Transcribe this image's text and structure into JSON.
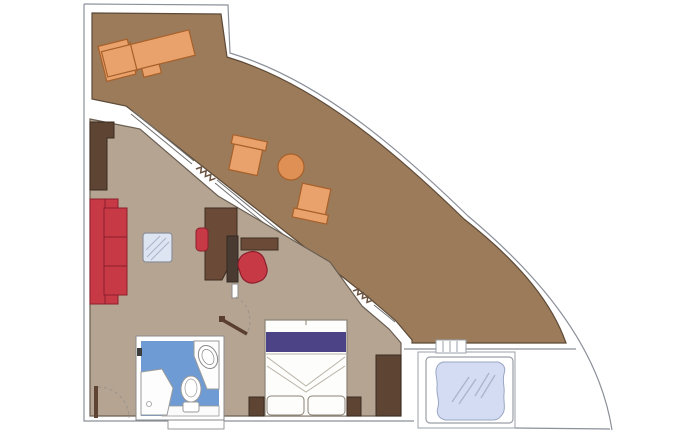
{
  "diagram": {
    "type": "floorplan",
    "subject": "cruise-ship-suite-with-wraparound-balcony-and-whirlpool",
    "rooms": [
      {
        "name": "balcony-terrace"
      },
      {
        "name": "living-room"
      },
      {
        "name": "bedroom"
      },
      {
        "name": "bathroom"
      },
      {
        "name": "whirlpool-deck"
      }
    ],
    "furniture": [
      {
        "name": "sun-lounger",
        "room": "balcony-terrace"
      },
      {
        "name": "deck-chair-1",
        "room": "balcony-terrace"
      },
      {
        "name": "deck-chair-2",
        "room": "balcony-terrace"
      },
      {
        "name": "round-table",
        "room": "balcony-terrace"
      },
      {
        "name": "sofa",
        "room": "living-room"
      },
      {
        "name": "glass-coffee-table",
        "room": "living-room"
      },
      {
        "name": "desk",
        "room": "living-room"
      },
      {
        "name": "desk-chair",
        "room": "living-room"
      },
      {
        "name": "tv-cabinet",
        "room": "living-room"
      },
      {
        "name": "console-shelf",
        "room": "living-room"
      },
      {
        "name": "tub-chair",
        "room": "living-room"
      },
      {
        "name": "entry-wardrobe",
        "room": "living-room"
      },
      {
        "name": "double-bed",
        "room": "bedroom"
      },
      {
        "name": "nightstand-left",
        "room": "bedroom"
      },
      {
        "name": "nightstand-right",
        "room": "bedroom"
      },
      {
        "name": "wardrobe",
        "room": "bedroom"
      },
      {
        "name": "shower",
        "room": "bathroom"
      },
      {
        "name": "toilet",
        "room": "bathroom"
      },
      {
        "name": "washbasin",
        "room": "bathroom"
      },
      {
        "name": "whirlpool-tub",
        "room": "whirlpool-deck"
      },
      {
        "name": "steps",
        "room": "whirlpool-deck"
      }
    ],
    "symbols": [
      {
        "name": "entry-door-swing"
      },
      {
        "name": "bedroom-door-swing"
      },
      {
        "name": "curtain-squiggle-living"
      },
      {
        "name": "curtain-squiggle-bedroom"
      },
      {
        "name": "hull-curve"
      }
    ]
  },
  "palette": {
    "bg": "#ffffff",
    "balcony-floor": "#9b7b5a",
    "balcony-stroke": "#5d4a38",
    "interior-floor": "#b5a492",
    "interior-stroke": "#6a5f52",
    "wood-dark": "#5d4433",
    "wood-dark-stroke": "#3c2d20",
    "wood-desk": "#6b4a37",
    "wood-slab": "#4a3b32",
    "red": "#c83946",
    "red-stroke": "#8b1e2c",
    "orange": "#e9a26c",
    "orange-deep": "#df9055",
    "orange-stroke": "#a8602a",
    "purple": "#4c4386",
    "bath-blue": "#6f9bd4",
    "glass-blue": "#dde4f2",
    "water-blue": "#d3dcf2",
    "water-stroke": "#9aa6c2",
    "fixture-stroke": "#9a9a9a",
    "line-gray": "#8b9099",
    "wall-line": "#707070",
    "dash-gray": "#9a9289",
    "fold-line": "#b9b3a7",
    "white": "#fdfdfc"
  }
}
